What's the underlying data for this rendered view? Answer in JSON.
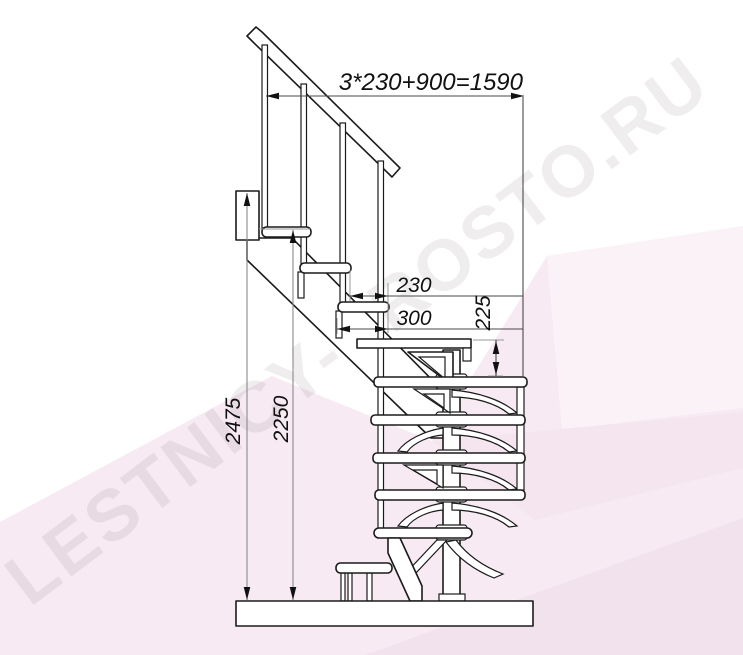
{
  "page": {
    "title": "Staircase side-view technical drawing"
  },
  "watermark": {
    "text": "LESTNICY-PROSTO.RU",
    "color": "#6b5564"
  },
  "dimensions": {
    "total_run": "3*230+900=1590",
    "step_run": "230",
    "tread_depth": "300",
    "riser_height": "225",
    "total_height": "2475",
    "upper_height": "2250"
  },
  "colors": {
    "line": "#1b1b1b",
    "dim_line": "#8a8a8a",
    "bg_pink_main": "#f7eaf2",
    "bg_pink_light": "#fbf2f8",
    "bg_pink_mid": "#f5e5ef",
    "bg_pink_dark": "#f2e2ed"
  }
}
